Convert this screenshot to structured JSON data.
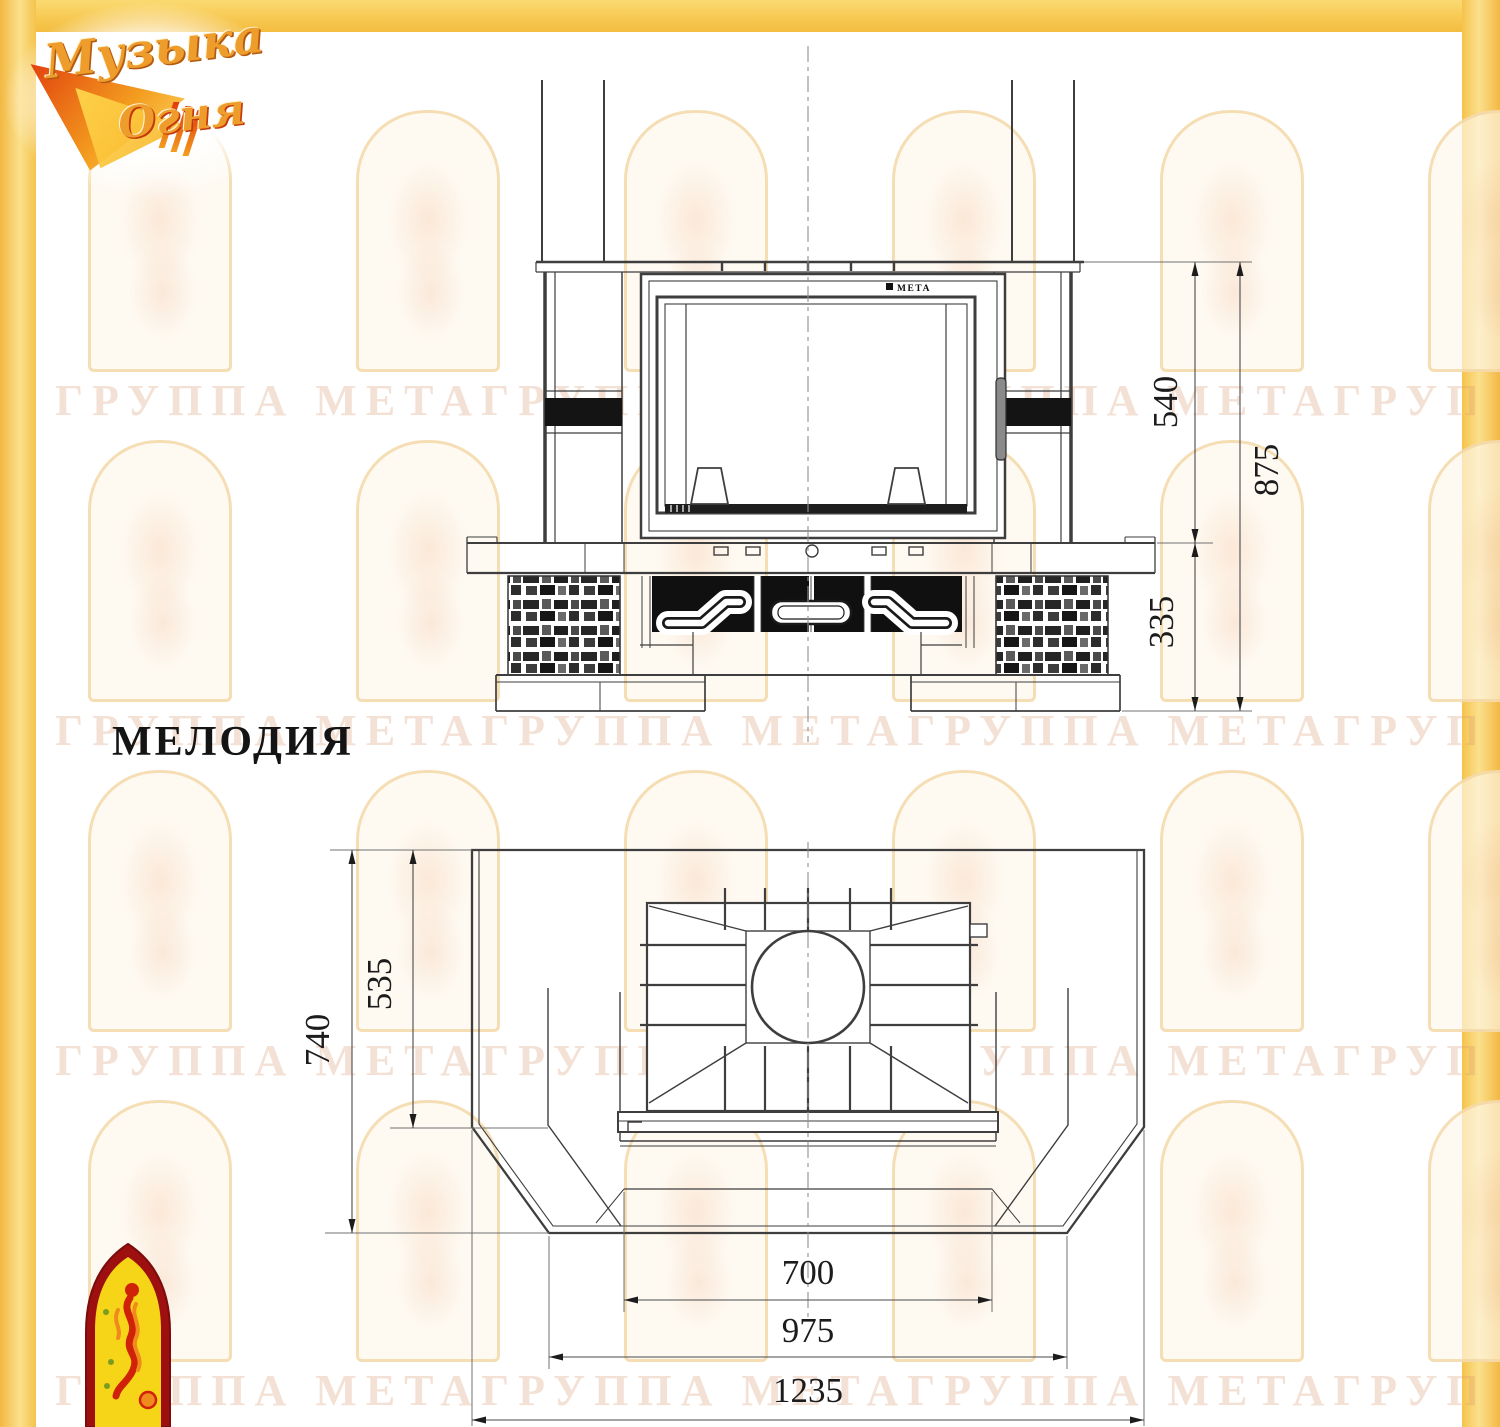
{
  "title": {
    "model_name": "МЕЛОДИЯ"
  },
  "logo_top": {
    "word1": "Музыка",
    "word2": "Огня"
  },
  "watermark": {
    "row_text": "ГРУППА МЕТАГРУППА МЕТАГРУППА МЕТАГРУППА МЕТА"
  },
  "front_view": {
    "brand_label": "МЕТА",
    "dimensions": {
      "firebox_height": "540",
      "total_height": "875",
      "base_height": "335"
    }
  },
  "plan_view": {
    "dimensions": {
      "depth_total": "740",
      "depth_inner": "535",
      "width_firebox": "700",
      "width_front": "975",
      "width_total": "1235"
    }
  },
  "colors": {
    "accent_yellow": "#f6c54b",
    "drawing_line": "#3e3e3e",
    "black_fill": "#111111"
  }
}
